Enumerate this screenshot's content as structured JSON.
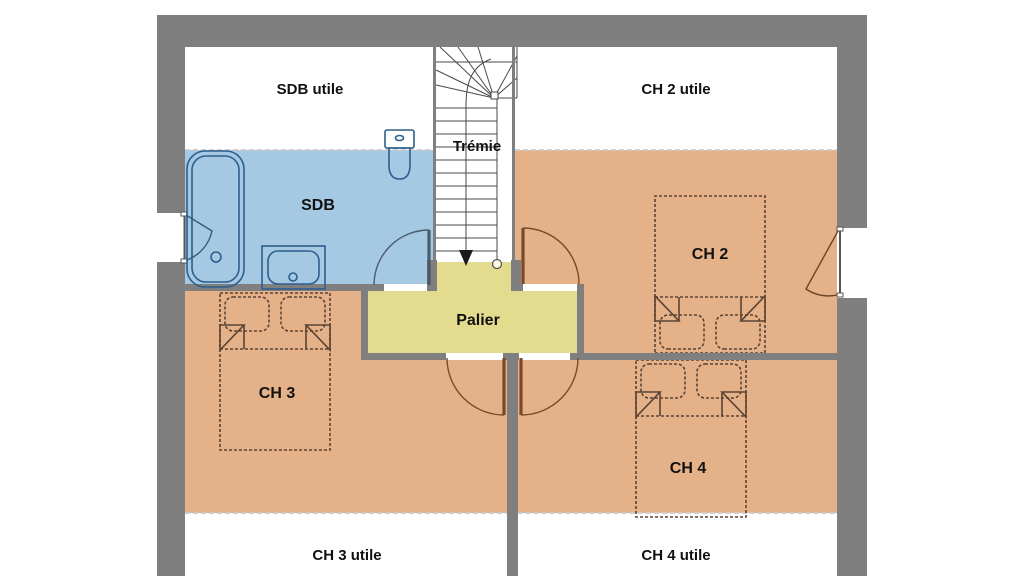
{
  "floor_plan": {
    "title": "Etage - plan",
    "rooms": {
      "sdb_utile": {
        "label": "SDB utile"
      },
      "ch2_utile": {
        "label": "CH 2 utile"
      },
      "tremie": {
        "label": "Trémie"
      },
      "sdb": {
        "label": "SDB"
      },
      "ch2": {
        "label": "CH 2"
      },
      "palier": {
        "label": "Palier"
      },
      "ch3": {
        "label": "CH 3"
      },
      "ch4": {
        "label": "CH 4"
      },
      "ch3_utile": {
        "label": "CH 3 utile"
      },
      "ch4_utile": {
        "label": "CH 4 utile"
      }
    },
    "colors": {
      "wall": "#7f7f7f",
      "bathroom_fill": "#a5c8e3",
      "bedroom_fill": "#e5b188",
      "landing_fill": "#e3dc8e",
      "fixture_outline": "#2d5e8c",
      "door_room": "#7a4a28",
      "door_bathroom": "#4a5a68",
      "bed_outline": "#5b4333",
      "stair_line": "#444444",
      "text": "#111111",
      "white": "#ffffff"
    }
  }
}
